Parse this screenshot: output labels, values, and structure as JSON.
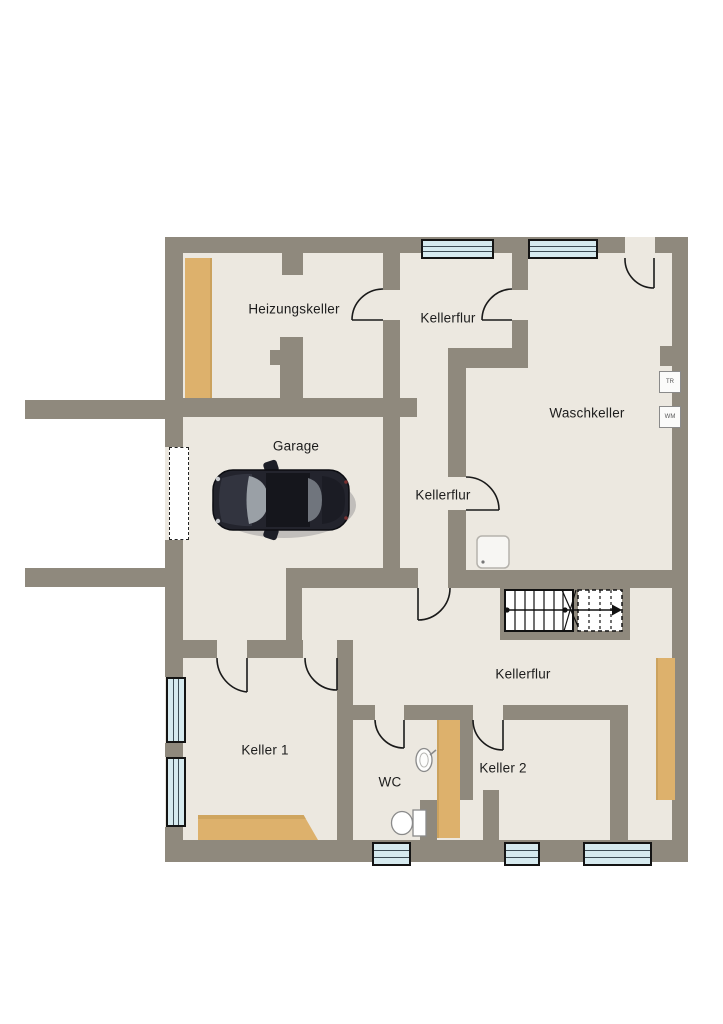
{
  "plan": {
    "type": "basement-floor-plan",
    "rooms": {
      "heizungskeller": {
        "label": "Heizungskeller"
      },
      "kellerflur_upper": {
        "label": "Kellerflur"
      },
      "waschkeller": {
        "label": "Waschkeller"
      },
      "garage": {
        "label": "Garage"
      },
      "kellerflur_middle": {
        "label": "Kellerflur"
      },
      "kellerflur_lower": {
        "label": "Kellerflur"
      },
      "keller1": {
        "label": "Keller 1"
      },
      "wc": {
        "label": "WC"
      },
      "keller2": {
        "label": "Keller 2"
      }
    },
    "appliances": {
      "dryer": "TR",
      "washer": "WM"
    },
    "fixtures": [
      "stairs-with-direction-arrow",
      "shower-tray",
      "toilet",
      "sink",
      "car",
      "garage-door",
      "workbench",
      "shelves"
    ],
    "colors": {
      "wall": "#8f897d",
      "floor": "#ece8e0",
      "wood": "#ddb16c",
      "window_glass": "#d6eaef",
      "outline": "#1a1a1a",
      "background": "#ffffff"
    }
  }
}
